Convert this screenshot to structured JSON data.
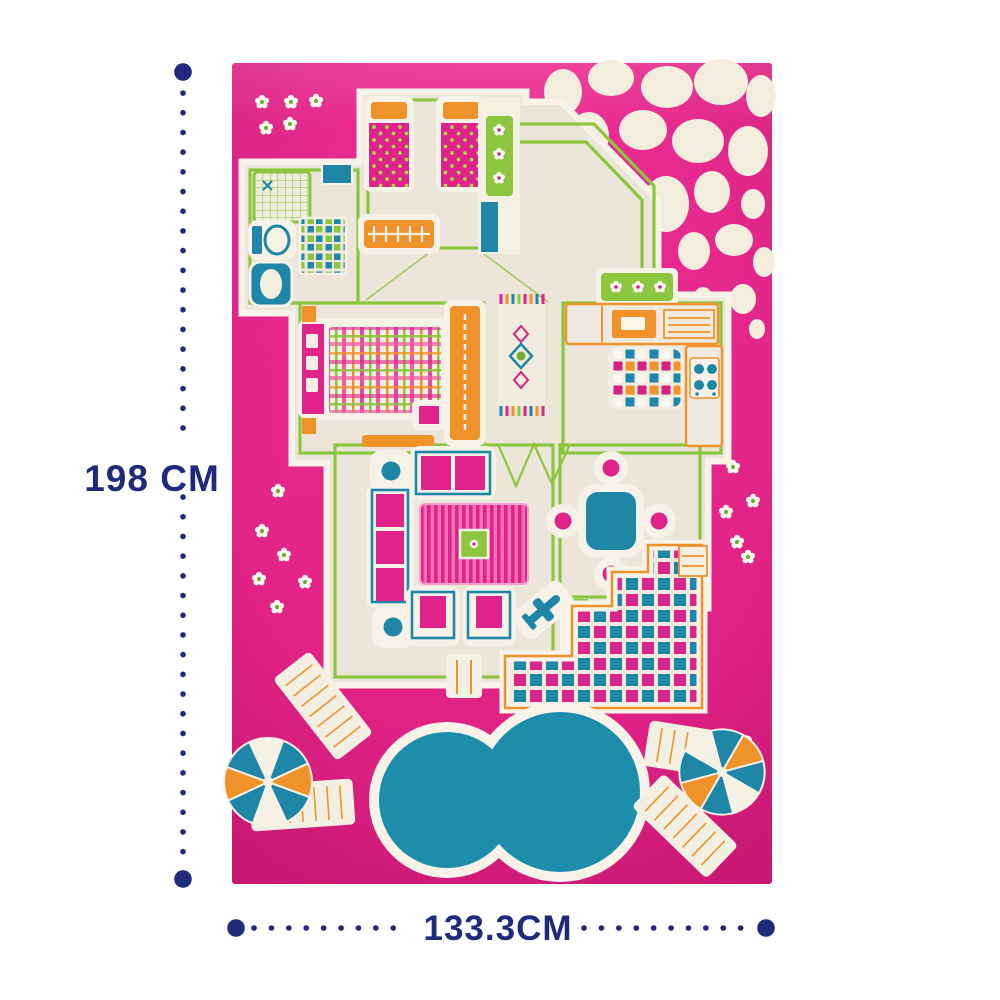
{
  "annotations": {
    "height_label": "198 CM",
    "width_label": "133.3CM",
    "line_style": "dotted with round endpoints"
  },
  "colors": {
    "navy": "#1f2a7b",
    "rugPink": "#e82a90",
    "rugPinkDark": "#d41e7e",
    "cream": "#ebe6d9",
    "rimWhite": "#f7f3e9",
    "green": "#8cc63f",
    "orange": "#f0922a",
    "magenta": "#e0238a",
    "teal": "#1f86a8",
    "stone": "#f3edde"
  },
  "product": {
    "description": "pink 3D play-house rug with house floor plan, pool and garden",
    "features": [
      "kids-bedroom-two-beds",
      "closet-flower-strip",
      "stone-path-corner",
      "bathroom-shower-toilet-bathtub",
      "checkered-bath-mat",
      "master-bedroom-plaid-bed",
      "orange-wardrobe",
      "hallway-runner-rug",
      "kitchen-counters-stove",
      "kitchen-check-rug",
      "living-room-sofa-armchairs",
      "striped-living-rug",
      "toy-plane-tile",
      "dining-table-four-seats",
      "checkerboard-patio",
      "kidney-pool",
      "four-lounge-chairs",
      "two-pinwheel-umbrellas",
      "white-daisies",
      "white-pebbles"
    ]
  }
}
